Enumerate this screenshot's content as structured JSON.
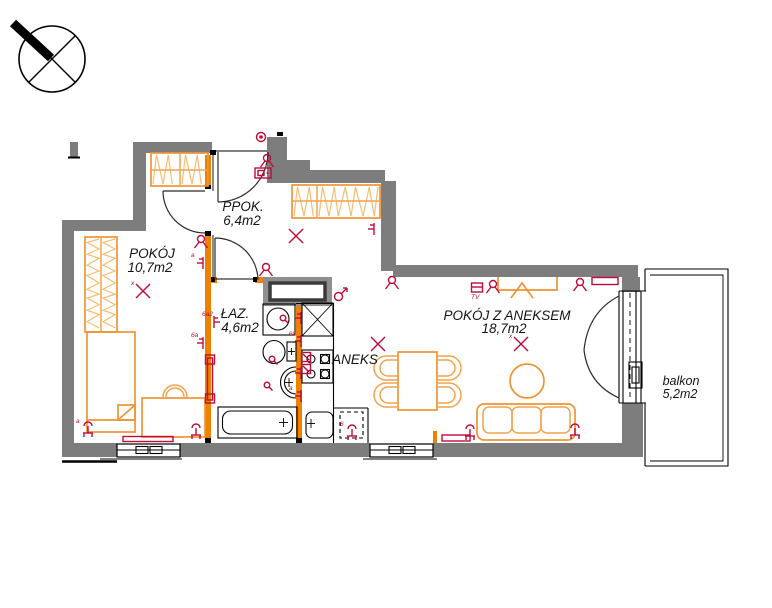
{
  "drawing": {
    "kind": "apartment-floor-plan",
    "north_arrow": "compass pointing north-west"
  },
  "rooms": [
    {
      "name": "PPOK.",
      "area": "6,4m2"
    },
    {
      "name": "POKÓJ",
      "area": "10,7m2"
    },
    {
      "name": "ŁAZ.",
      "area": "4,6m2"
    },
    {
      "name": "ANEKS",
      "area": ""
    },
    {
      "name": "POKÓJ Z ANEKSEM",
      "area": "18,7m2"
    },
    {
      "name": "balkon",
      "area": "5,2m2"
    }
  ],
  "colors": {
    "wall_gray": "#7d7d7d",
    "shaft_gray": "#8f8f8f",
    "masonry_orange": "#ee8100",
    "furniture_orange": "#ef9434",
    "hatch_orange": "#f8bd72",
    "electric_red": "#c00a3a",
    "line_black": "#000000"
  },
  "wardrobes": [
    {
      "x": 151,
      "y": 153,
      "w": 57,
      "h": 33,
      "divider": 180,
      "mid": 170,
      "dir": "h"
    },
    {
      "x": 292,
      "y": 185,
      "w": 88,
      "h": 33,
      "divider": 317,
      "mid": 201,
      "dir": "h"
    },
    {
      "x": 85,
      "y": 237,
      "w": 32,
      "h": 95,
      "divider": 101,
      "dir": "v"
    }
  ],
  "symbols": [
    {
      "type": "junction_box",
      "x": 261,
      "y": 137
    },
    {
      "type": "wall_light",
      "x": 267,
      "y": 161
    },
    {
      "type": "intercom",
      "x": 263,
      "y": 173
    },
    {
      "type": "ceiling_light_x",
      "x": 296,
      "y": 236
    },
    {
      "type": "socket",
      "x": 374,
      "y": 229,
      "dir": -1
    },
    {
      "type": "wall_light",
      "x": 266,
      "y": 270
    },
    {
      "type": "mars",
      "x": 340,
      "y": 295
    },
    {
      "type": "wall_light",
      "x": 201,
      "y": 242
    },
    {
      "type": "socket",
      "x": 203,
      "y": 263,
      "dir": -1,
      "label": "a"
    },
    {
      "type": "ceiling_light_x",
      "x": 143,
      "y": 291,
      "label": "x"
    },
    {
      "type": "socket",
      "x": 203,
      "y": 343,
      "dir": -1,
      "label": "6a"
    },
    {
      "type": "socket_column",
      "x": 210,
      "y": 379
    },
    {
      "type": "socket",
      "x": 214,
      "y": 322,
      "dir": 1,
      "label": "6a2"
    },
    {
      "type": "floor_socket",
      "x": 88,
      "y": 429,
      "label": "a"
    },
    {
      "type": "floor_socket",
      "x": 196,
      "y": 431
    },
    {
      "type": "radiator",
      "x": 148,
      "y": 439,
      "w": 50,
      "h": 5
    },
    {
      "type": "dot",
      "x": 283,
      "y": 318
    },
    {
      "type": "socket",
      "x": 301,
      "y": 318,
      "dir": -1
    },
    {
      "type": "socket",
      "x": 301,
      "y": 341,
      "dir": -1,
      "label": "ex"
    },
    {
      "type": "socket_box",
      "x": 306,
      "y": 357
    },
    {
      "type": "socket_box",
      "x": 306,
      "y": 369
    },
    {
      "type": "socket",
      "x": 301,
      "y": 373,
      "dir": -1
    },
    {
      "type": "socket",
      "x": 301,
      "y": 396,
      "dir": -1,
      "label": "a"
    },
    {
      "type": "dot",
      "x": 272,
      "y": 359
    },
    {
      "type": "dot",
      "x": 267,
      "y": 385
    },
    {
      "type": "wall_light",
      "x": 392,
      "y": 283
    },
    {
      "type": "tv_socket",
      "x": 477,
      "y": 288,
      "label": "TV"
    },
    {
      "type": "wall_light",
      "x": 493,
      "y": 287
    },
    {
      "type": "wall_light",
      "x": 580,
      "y": 285
    },
    {
      "type": "radiator",
      "x": 605,
      "y": 281,
      "w": 26,
      "h": 7
    },
    {
      "type": "ceiling_light_x",
      "x": 378,
      "y": 344
    },
    {
      "type": "ceiling_light_x",
      "x": 521,
      "y": 344,
      "label": "x"
    },
    {
      "type": "radiator",
      "x": 456,
      "y": 438,
      "w": 28,
      "h": 6
    },
    {
      "type": "floor_socket",
      "x": 470,
      "y": 432
    },
    {
      "type": "floor_socket",
      "x": 575,
      "y": 431
    },
    {
      "type": "floor_socket",
      "x": 352,
      "y": 432,
      "label": "6"
    }
  ]
}
